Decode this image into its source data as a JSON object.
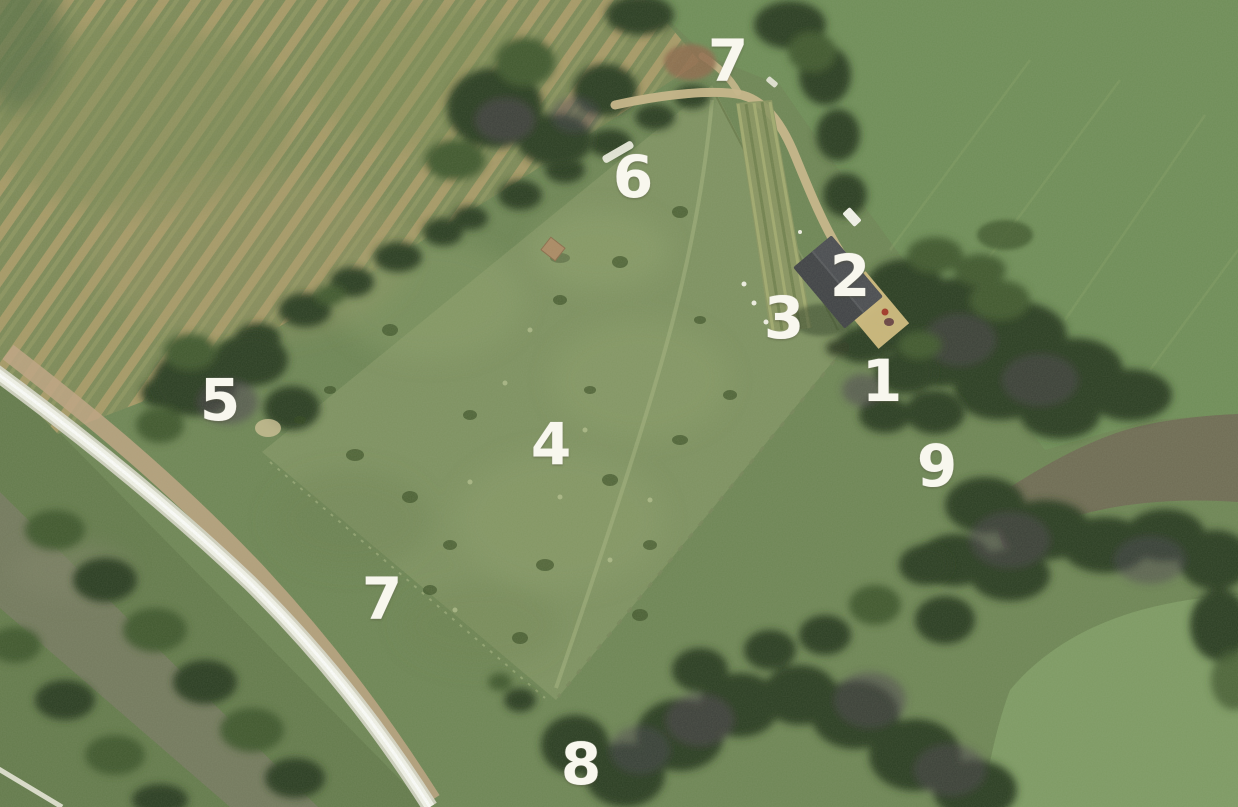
{
  "scene": {
    "type": "annotated-aerial-photograph",
    "description": "Satellite view of a triangular smallholding bordered by tree lines, a road and canal to the south-west, a winding tree-lined river to the east, with numbered feature markers 1-9 overlaid in white"
  },
  "markers": [
    {
      "label": "7",
      "x": 727,
      "y": 61
    },
    {
      "label": "6",
      "x": 632,
      "y": 177
    },
    {
      "label": "2",
      "x": 849,
      "y": 276
    },
    {
      "label": "3",
      "x": 783,
      "y": 318
    },
    {
      "label": "1",
      "x": 881,
      "y": 381
    },
    {
      "label": "5",
      "x": 219,
      "y": 400
    },
    {
      "label": "4",
      "x": 550,
      "y": 444
    },
    {
      "label": "9",
      "x": 936,
      "y": 466
    },
    {
      "label": "7",
      "x": 381,
      "y": 599
    },
    {
      "label": "8",
      "x": 580,
      "y": 764
    }
  ],
  "colors": {
    "base_green": "#6e8655",
    "underlayer_green": "#647b4c",
    "parcel_green": "#7e9261",
    "fieldTL_green": "#7d8a58",
    "fieldTL_tan": "#a79a67",
    "fieldTL_olive": "#8d9560",
    "fieldTR_green": "#6f8e58",
    "meadow_green": "#7e9b64",
    "tree_dark": "#2c3e23",
    "tree_mid": "#41592f",
    "tree_purple": "#4a4150",
    "water_canal": "#747a5e",
    "water_river": "#6f6c54",
    "road_white": "#f2f3ea",
    "verge_tan": "#c0a584",
    "track_tan": "#c8b689",
    "roof_dark": "#3f4145",
    "yard_tan": "#d2bc7e",
    "hut_tan": "#ab8a64",
    "soil_brown": "#8f6b4e",
    "marker_white": "#f8f7ee"
  }
}
